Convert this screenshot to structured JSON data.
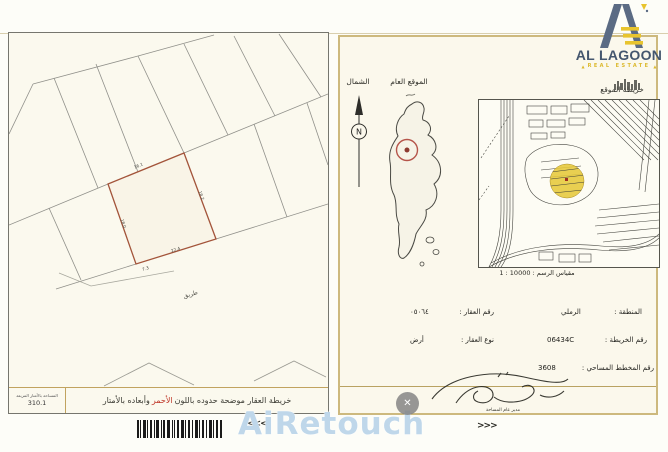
{
  "logo": {
    "title": "AL LAGOON",
    "subtitle": "REAL ESTATE",
    "tri": "▲"
  },
  "left_page": {
    "road_label": "طريق",
    "dims": {
      "top": "16.1",
      "right": "18.2",
      "left": "18.0",
      "bottom": "22.4",
      "corner": "7.3"
    },
    "footer": {
      "area_label": "المساحة بالأمتار المربعة",
      "area_value": "310.1",
      "caption_pre": "خريطة العقار موضحة حدوده باللون",
      "caption_red": "الأحمر",
      "caption_post": "وأبعاده بالأمتار"
    }
  },
  "right_page": {
    "north_label": "الشمال",
    "general_label": "الموقع العام",
    "compass_n": "N",
    "sitemap_label": "خريطة الموقع",
    "scale_text": "مقياس الرسم : 10000 : 1",
    "fields": {
      "district_label": "المنطقة :",
      "district_value": "الرملي",
      "property_no_label": "رقم العقار :",
      "property_no_value": "٠٥٠٦٤",
      "map_no_label": "رقم الخريطة :",
      "map_no_value": "06434C",
      "type_label": "نوع العقار :",
      "type_value": "أرض",
      "plan_no_label": "رقم المخطط المساحي :",
      "plan_no_value": "3608"
    },
    "signature_caption": "مدير عام المساحة"
  },
  "bottom": {
    "watermark": "AiRetouch",
    "chevrons_left": "<<<",
    "chevrons_right": ">>>",
    "close": "✕"
  }
}
